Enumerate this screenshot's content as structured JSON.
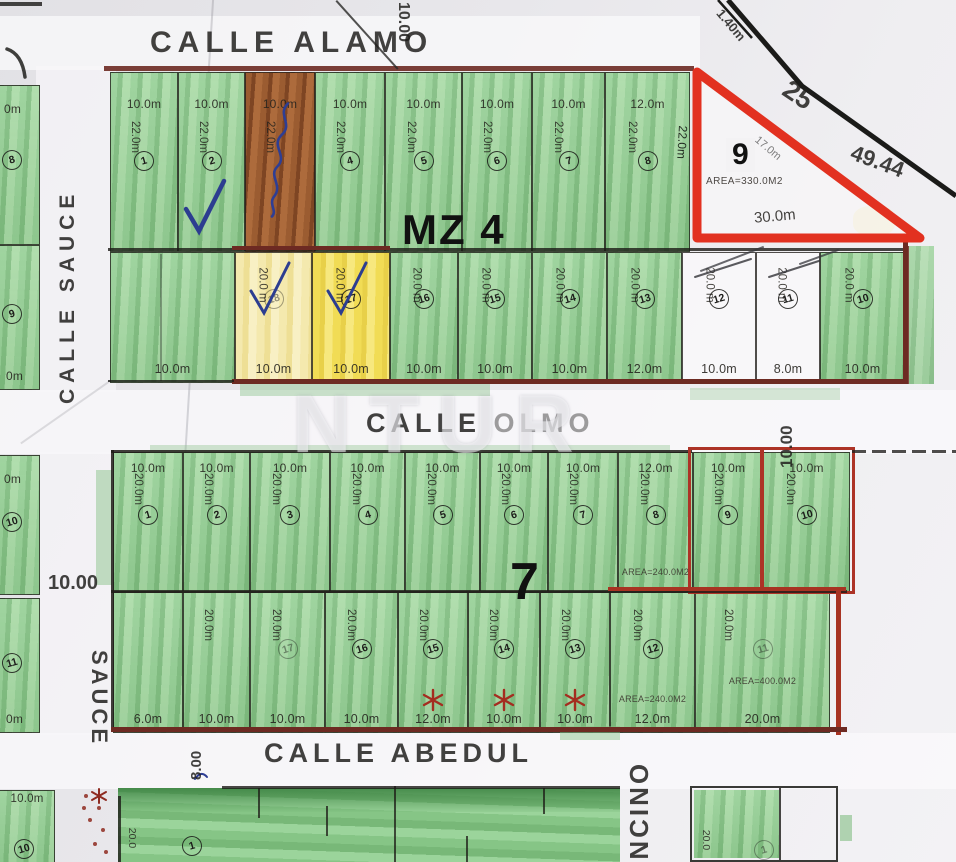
{
  "watermark": "NTUR",
  "streets": {
    "top": {
      "name": "CALLE ALAMO"
    },
    "middle": {
      "name_1": "CALLE",
      "name_2": "OLMO"
    },
    "bottom": {
      "name": "CALLE ABEDUL"
    },
    "left_upper": {
      "name": "CALLE SAUCE"
    },
    "left_lower": {
      "name": "SAUCE"
    },
    "right_lower": {
      "name": "ENCINO"
    },
    "widths": {
      "top": "10.00",
      "left": "10.00",
      "right": "10.00",
      "bottom": "8.00"
    }
  },
  "boundary": {
    "seg1": "1.40m",
    "seg2": "25",
    "seg3": "49.44"
  },
  "mz4": {
    "label": "MZ 4",
    "lot9": {
      "n": "9",
      "area": "AREA=330.0M2",
      "front": "30.0m",
      "side": "22.0m",
      "diag": "17.0m"
    },
    "row1": {
      "y": 72,
      "h": 180,
      "depth": "22.0m",
      "lots": [
        {
          "n": "1",
          "x": 110,
          "w": 68,
          "width": "10.0m",
          "fill": "green"
        },
        {
          "n": "2",
          "x": 178,
          "w": 67,
          "width": "10.0m",
          "fill": "green",
          "mark": "check"
        },
        {
          "n": "",
          "x": 245,
          "w": 70,
          "width": "10.0m",
          "fill": "brown",
          "mark": "scribble"
        },
        {
          "n": "4",
          "x": 315,
          "w": 70,
          "width": "10.0m",
          "fill": "green"
        },
        {
          "n": "5",
          "x": 385,
          "w": 77,
          "width": "10.0m",
          "fill": "green"
        },
        {
          "n": "6",
          "x": 462,
          "w": 70,
          "width": "10.0m",
          "fill": "green"
        },
        {
          "n": "7",
          "x": 532,
          "w": 73,
          "width": "10.0m",
          "fill": "green"
        },
        {
          "n": "8",
          "x": 605,
          "w": 85,
          "width": "12.0m",
          "fill": "green"
        }
      ]
    },
    "row2": {
      "y": 252,
      "h": 131,
      "depth": "20.0 m",
      "lots": [
        {
          "n": "",
          "x": 110,
          "w": 125,
          "width": "10.0m",
          "fill": "green",
          "nodepth": true
        },
        {
          "n": "18",
          "x": 235,
          "w": 77,
          "width": "10.0m",
          "fill": "paleyellow",
          "mark": "check",
          "dim": true
        },
        {
          "n": "17",
          "x": 312,
          "w": 78,
          "width": "10.0m",
          "fill": "yellow",
          "mark": "check"
        },
        {
          "n": "16",
          "x": 390,
          "w": 68,
          "width": "10.0m",
          "fill": "green"
        },
        {
          "n": "15",
          "x": 458,
          "w": 74,
          "width": "10.0m",
          "fill": "green"
        },
        {
          "n": "14",
          "x": 532,
          "w": 75,
          "width": "10.0m",
          "fill": "green"
        },
        {
          "n": "13",
          "x": 607,
          "w": 75,
          "width": "12.0m",
          "fill": "green"
        },
        {
          "n": "12",
          "x": 682,
          "w": 74,
          "width": "10.0m",
          "fill": "white",
          "mark": "slash"
        },
        {
          "n": "11",
          "x": 756,
          "w": 64,
          "width": "8.0m",
          "fill": "white",
          "mark": "slash"
        },
        {
          "n": "10",
          "x": 820,
          "w": 85,
          "width": "10.0m",
          "fill": "green"
        }
      ]
    }
  },
  "b7": {
    "label": "7",
    "row1": {
      "y": 452,
      "h": 140,
      "depth": "20.0m",
      "lots": [
        {
          "n": "1",
          "x": 113,
          "w": 70,
          "width": "10.0m",
          "fill": "green"
        },
        {
          "n": "2",
          "x": 183,
          "w": 67,
          "width": "10.0m",
          "fill": "green"
        },
        {
          "n": "3",
          "x": 250,
          "w": 80,
          "width": "10.0m",
          "fill": "green"
        },
        {
          "n": "4",
          "x": 330,
          "w": 75,
          "width": "10.0m",
          "fill": "green"
        },
        {
          "n": "5",
          "x": 405,
          "w": 75,
          "width": "10.0m",
          "fill": "green"
        },
        {
          "n": "6",
          "x": 480,
          "w": 68,
          "width": "10.0m",
          "fill": "green"
        },
        {
          "n": "7",
          "x": 548,
          "w": 70,
          "width": "10.0m",
          "fill": "green"
        },
        {
          "n": "8",
          "x": 618,
          "w": 75,
          "width": "12.0m",
          "fill": "green",
          "area": "AREA=240.0M2",
          "ab": 14
        },
        {
          "n": "9",
          "x": 693,
          "w": 70,
          "width": "10.0m",
          "fill": "green"
        },
        {
          "n": "10",
          "x": 763,
          "w": 87,
          "width": "10.0m",
          "fill": "green"
        }
      ]
    },
    "row2": {
      "y": 592,
      "h": 141,
      "depth": "20.0m",
      "lots": [
        {
          "n": "",
          "x": 113,
          "w": 70,
          "bwidth": "6.0m",
          "fill": "green",
          "nodepth": true
        },
        {
          "n": "",
          "x": 183,
          "w": 67,
          "bwidth": "10.0m",
          "fill": "green"
        },
        {
          "n": "17",
          "x": 250,
          "w": 75,
          "bwidth": "10.0m",
          "fill": "green",
          "dim": true
        },
        {
          "n": "16",
          "x": 325,
          "w": 73,
          "bwidth": "10.0m",
          "fill": "green"
        },
        {
          "n": "15",
          "x": 398,
          "w": 70,
          "bwidth": "12.0m",
          "fill": "green",
          "mark": "star"
        },
        {
          "n": "14",
          "x": 468,
          "w": 72,
          "bwidth": "10.0m",
          "fill": "green",
          "mark": "star"
        },
        {
          "n": "13",
          "x": 540,
          "w": 70,
          "bwidth": "10.0m",
          "fill": "green",
          "mark": "star"
        },
        {
          "n": "12",
          "x": 610,
          "w": 85,
          "bwidth": "12.0m",
          "fill": "green",
          "area": "AREA=240.0M2",
          "ab": 28
        },
        {
          "n": "11",
          "x": 695,
          "w": 135,
          "bwidth": "20.0m",
          "fill": "green",
          "area": "AREA=400.0M2",
          "ab": 46,
          "dim": true
        }
      ]
    }
  },
  "left_column": {
    "street_width": "10.00",
    "lots": [
      {
        "n": "8",
        "y": 85,
        "h": 160,
        "top_label": "0m"
      },
      {
        "n": "9",
        "y": 245,
        "h": 145,
        "bottom_label": "0m"
      },
      {
        "n": "10",
        "y": 455,
        "h": 140,
        "top_label": "0m"
      },
      {
        "n": "11",
        "y": 598,
        "h": 135,
        "bottom_label": "0m"
      }
    ]
  },
  "bottom_row": {
    "corner": {
      "top_label": "10.0m",
      "n": "10",
      "side_label": "20"
    },
    "left_block": {
      "n": "1",
      "side_label": "20.0"
    },
    "right_block": {
      "n": "1",
      "side_label": "20.0"
    }
  }
}
